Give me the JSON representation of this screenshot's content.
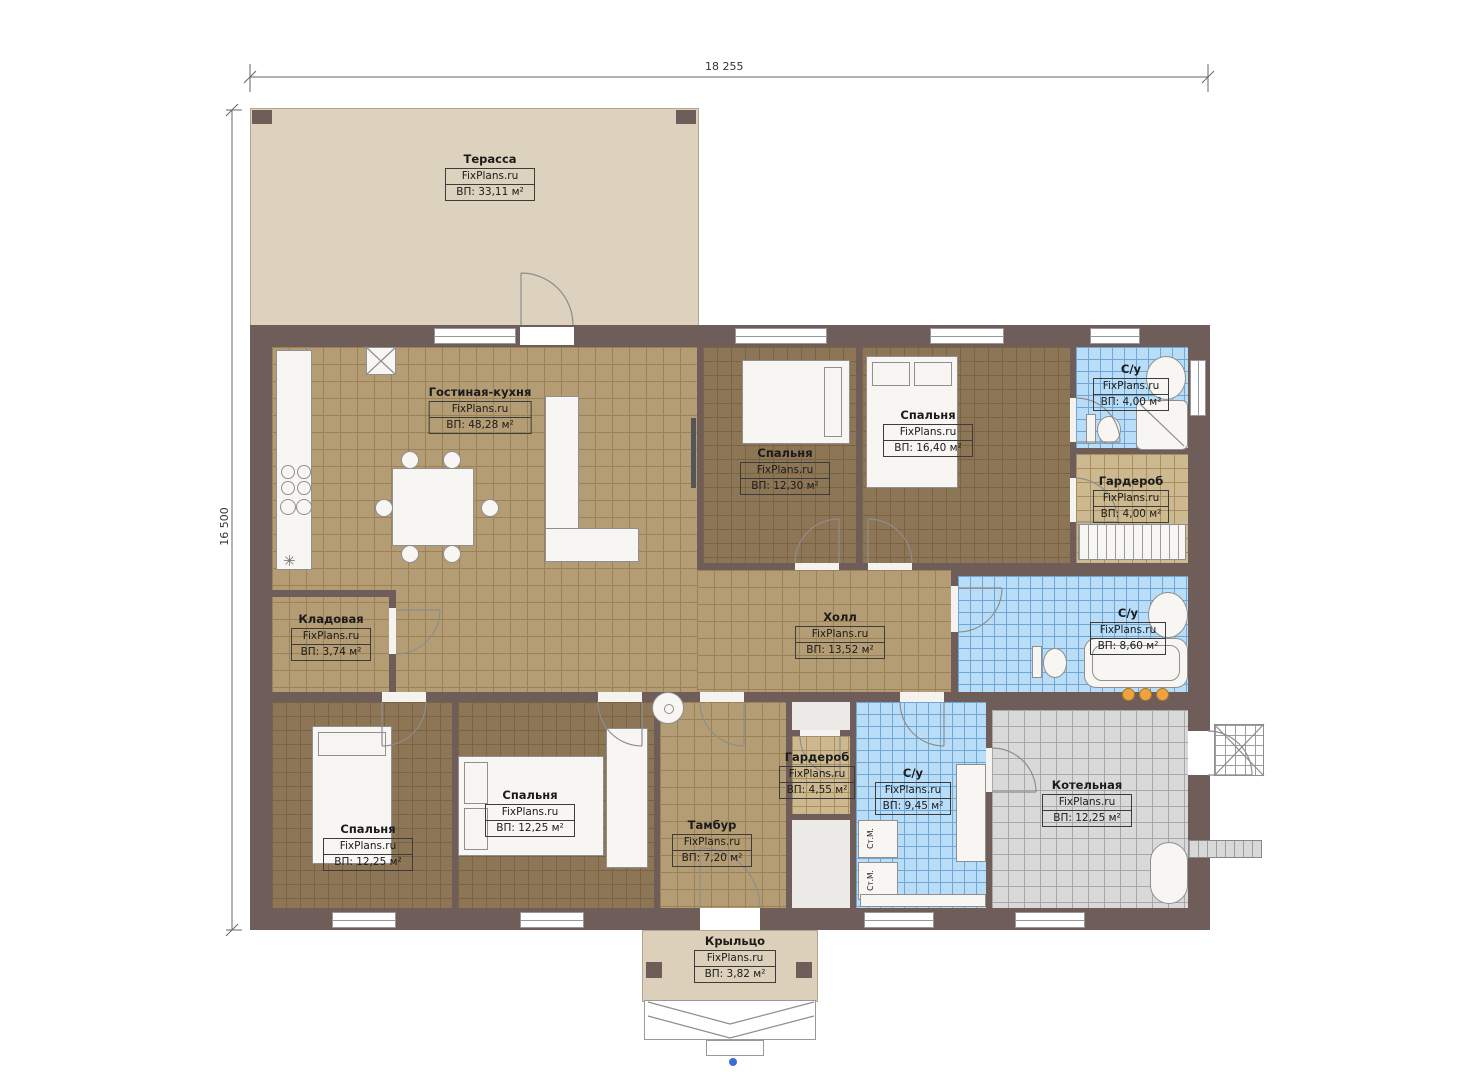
{
  "brand": "FixPlans.ru",
  "dimensions": {
    "width": "18 255",
    "height": "16 500"
  },
  "rooms": {
    "terrace": {
      "name": "Терасса",
      "area": "ВП: 33,11 м²"
    },
    "living": {
      "name": "Гостиная-кухня",
      "area": "ВП: 48,28 м²"
    },
    "bedroom_top": {
      "name": "Спальня",
      "area": "ВП: 12,30 м²"
    },
    "bedroom_right": {
      "name": "Спальня",
      "area": "ВП: 16,40 м²"
    },
    "bath_top": {
      "name": "С/у",
      "area": "ВП: 4,00 м²"
    },
    "wardrobe_top": {
      "name": "Гардероб",
      "area": "ВП: 4,00 м²"
    },
    "pantry": {
      "name": "Кладовая",
      "area": "ВП: 3,74 м²"
    },
    "hall": {
      "name": "Холл",
      "area": "ВП: 13,52 м²"
    },
    "bath_mid": {
      "name": "С/у",
      "area": "ВП: 8,60 м²"
    },
    "bedroom_bl": {
      "name": "Спальня",
      "area": "ВП: 12,25 м²"
    },
    "bedroom_bc": {
      "name": "Спальня",
      "area": "ВП: 12,25 м²"
    },
    "wardrobe_bottom": {
      "name": "Гардероб",
      "area": "ВП: 4,55 м²"
    },
    "tambour": {
      "name": "Тамбур",
      "area": "ВП: 7,20 м²"
    },
    "bath_bottom": {
      "name": "С/у",
      "area": "ВП: 9,45 м²"
    },
    "boiler": {
      "name": "Котельная",
      "area": "ВП: 12,25 м²"
    },
    "porch": {
      "name": "Крыльцо",
      "area": "ВП: 3,82 м²"
    }
  },
  "labels": {
    "washer": "Ст.М."
  },
  "icons": {
    "vent": "✳"
  },
  "colors": {
    "wall": "#6f5d5a",
    "floor_tan": "#b49d74",
    "floor_brown": "#8d7656",
    "floor_blue": "#b9ddf6",
    "floor_gray": "#d9d9d9",
    "terrace": "#ddd2bd",
    "accent_orange": "#eda33f"
  }
}
